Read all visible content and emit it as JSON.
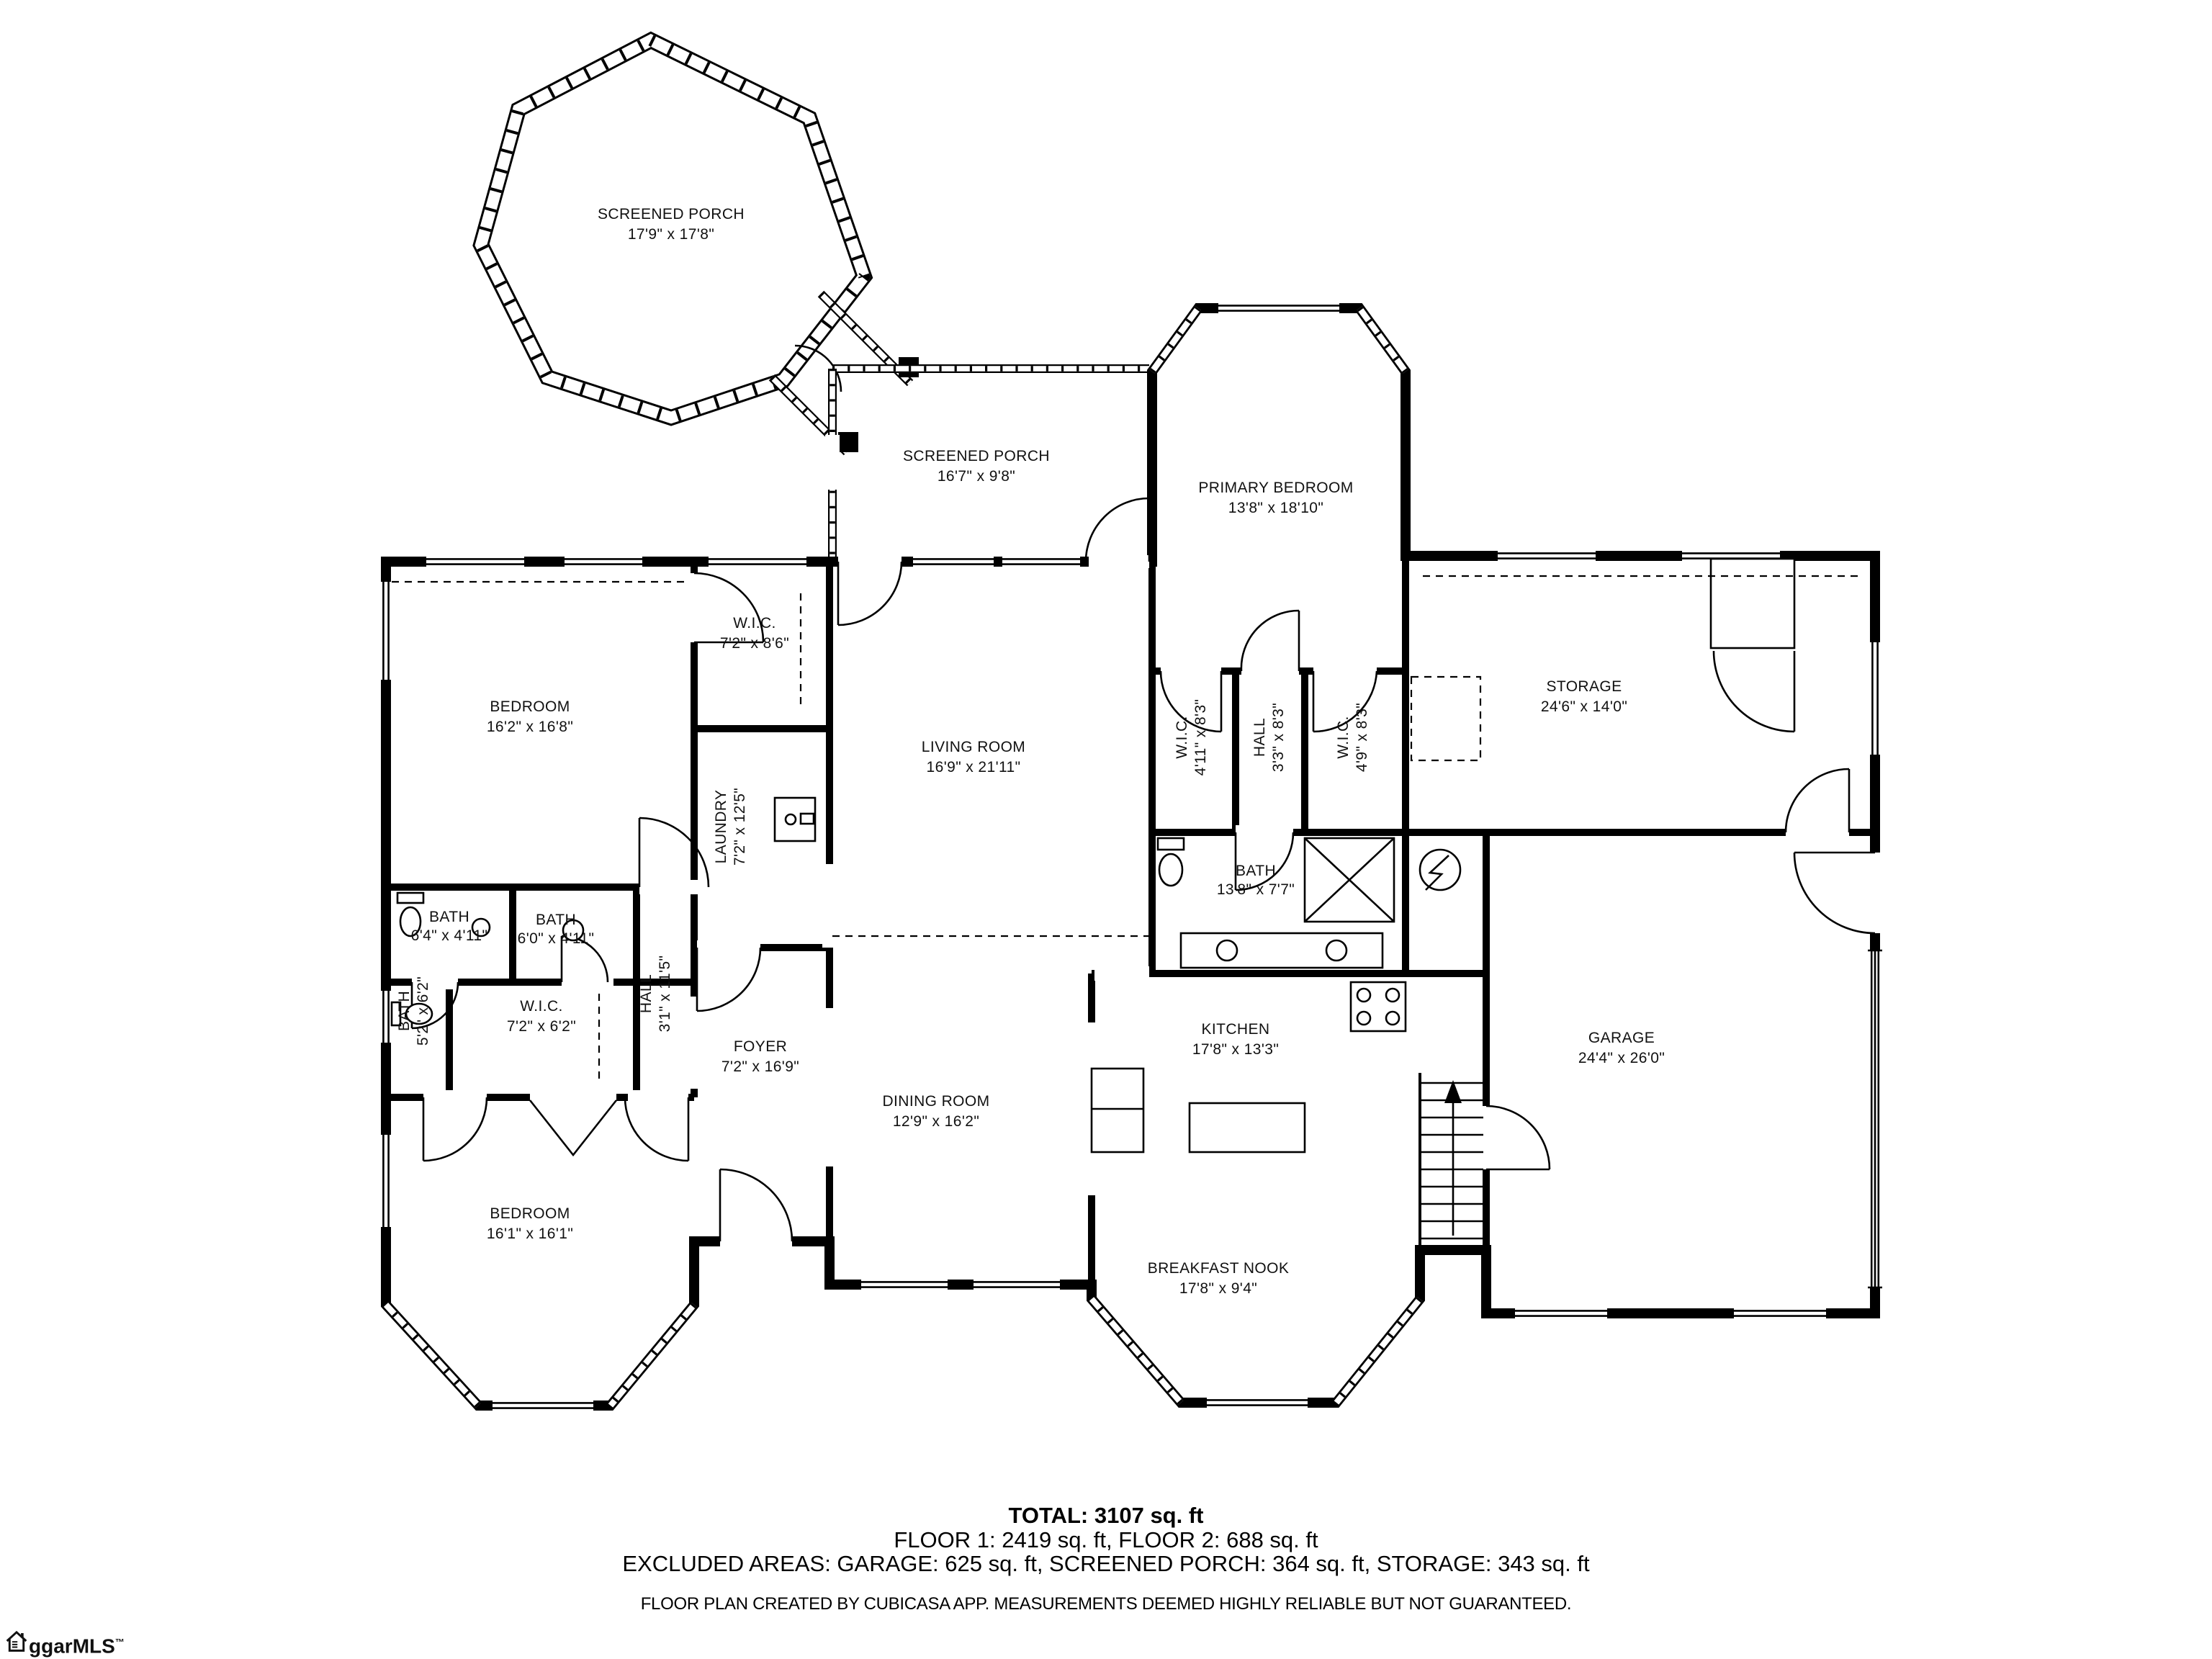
{
  "document": {
    "background": "#ffffff",
    "line_color": "#000000"
  },
  "rooms": {
    "screened_porch_upper": {
      "name": "SCREENED PORCH",
      "dims": "17'9\" x 17'8\""
    },
    "screened_porch_lower": {
      "name": "SCREENED PORCH",
      "dims": "16'7\" x 9'8\""
    },
    "primary_bedroom": {
      "name": "PRIMARY BEDROOM",
      "dims": "13'8\" x 18'10\""
    },
    "bedroom_upper": {
      "name": "BEDROOM",
      "dims": "16'2\" x 16'8\""
    },
    "wic_top": {
      "name": "W.I.C.",
      "dims": "7'2\" x 8'6\""
    },
    "living_room": {
      "name": "LIVING ROOM",
      "dims": "16'9\" x 21'11\""
    },
    "wic_left": {
      "name": "W.I.C.",
      "dims": "4'11\" x 8'3\""
    },
    "hall_center": {
      "name": "HALL",
      "dims": "3'3\" x 8'3\""
    },
    "wic_right": {
      "name": "W.I.C.",
      "dims": "4'9\" x 8'3\""
    },
    "storage": {
      "name": "STORAGE",
      "dims": "24'6\" x 14'0\""
    },
    "laundry": {
      "name": "LAUNDRY",
      "dims": "7'2\" x 12'5\""
    },
    "bath_1": {
      "name": "BATH",
      "dims": "6'4\" x 4'11\""
    },
    "bath_2": {
      "name": "BATH",
      "dims": "6'0\" x 4'11\""
    },
    "bath_primary": {
      "name": "BATH",
      "dims": "13'8\" x 7'7\""
    },
    "bath_3": {
      "name": "BATH",
      "dims": "5'2\" x 6'2\""
    },
    "wic_lower": {
      "name": "W.I.C.",
      "dims": "7'2\" x 6'2\""
    },
    "hall_lower": {
      "name": "HALL",
      "dims": "3'1\" x 11'5\""
    },
    "foyer": {
      "name": "FOYER",
      "dims": "7'2\" x 16'9\""
    },
    "dining_room": {
      "name": "DINING ROOM",
      "dims": "12'9\" x 16'2\""
    },
    "kitchen": {
      "name": "KITCHEN",
      "dims": "17'8\" x 13'3\""
    },
    "garage": {
      "name": "GARAGE",
      "dims": "24'4\" x 26'0\""
    },
    "bedroom_lower": {
      "name": "BEDROOM",
      "dims": "16'1\" x 16'1\""
    },
    "breakfast_nook": {
      "name": "BREAKFAST NOOK",
      "dims": "17'8\" x 9'4\""
    }
  },
  "summary": {
    "total": "TOTAL: 3107 sq. ft",
    "floors": "FLOOR 1: 2419 sq. ft, FLOOR 2: 688 sq. ft",
    "excluded": "EXCLUDED AREAS: GARAGE: 625 sq. ft, SCREENED PORCH: 364 sq. ft, STORAGE: 343 sq. ft",
    "disclaimer": "FLOOR PLAN CREATED BY CUBICASA APP. MEASUREMENTS DEEMED HIGHLY RELIABLE BUT NOT GUARANTEED."
  },
  "logo": {
    "prefix": "ggar",
    "suffix": "MLS",
    "trademark": "™",
    "icon": "house-icon"
  }
}
